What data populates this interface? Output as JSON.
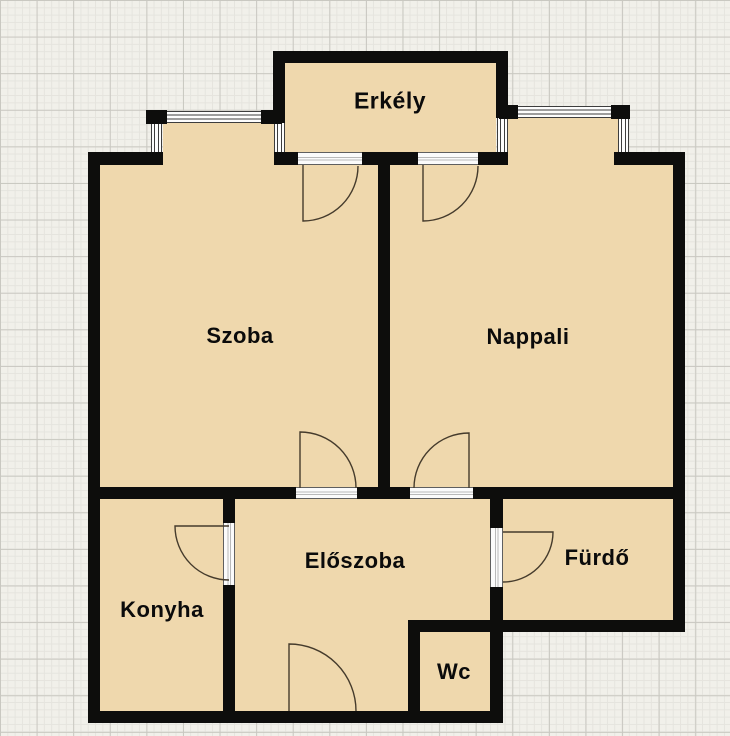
{
  "floorplan": {
    "rooms": [
      {
        "name": "Erkély"
      },
      {
        "name": "Szoba"
      },
      {
        "name": "Nappali"
      },
      {
        "name": "Konyha"
      },
      {
        "name": "Előszoba"
      },
      {
        "name": "Fürdő"
      },
      {
        "name": "Wc"
      }
    ],
    "colors": {
      "room_fill": "#efd8ad",
      "wall": "#0d0d0c",
      "door_arc": "#453b2c",
      "window_glyph": "#fdfdfd",
      "grid_background": "#f1f0ea",
      "grid_minor_line": "#e5e4de",
      "grid_major_line": "#c9c8c1"
    }
  }
}
